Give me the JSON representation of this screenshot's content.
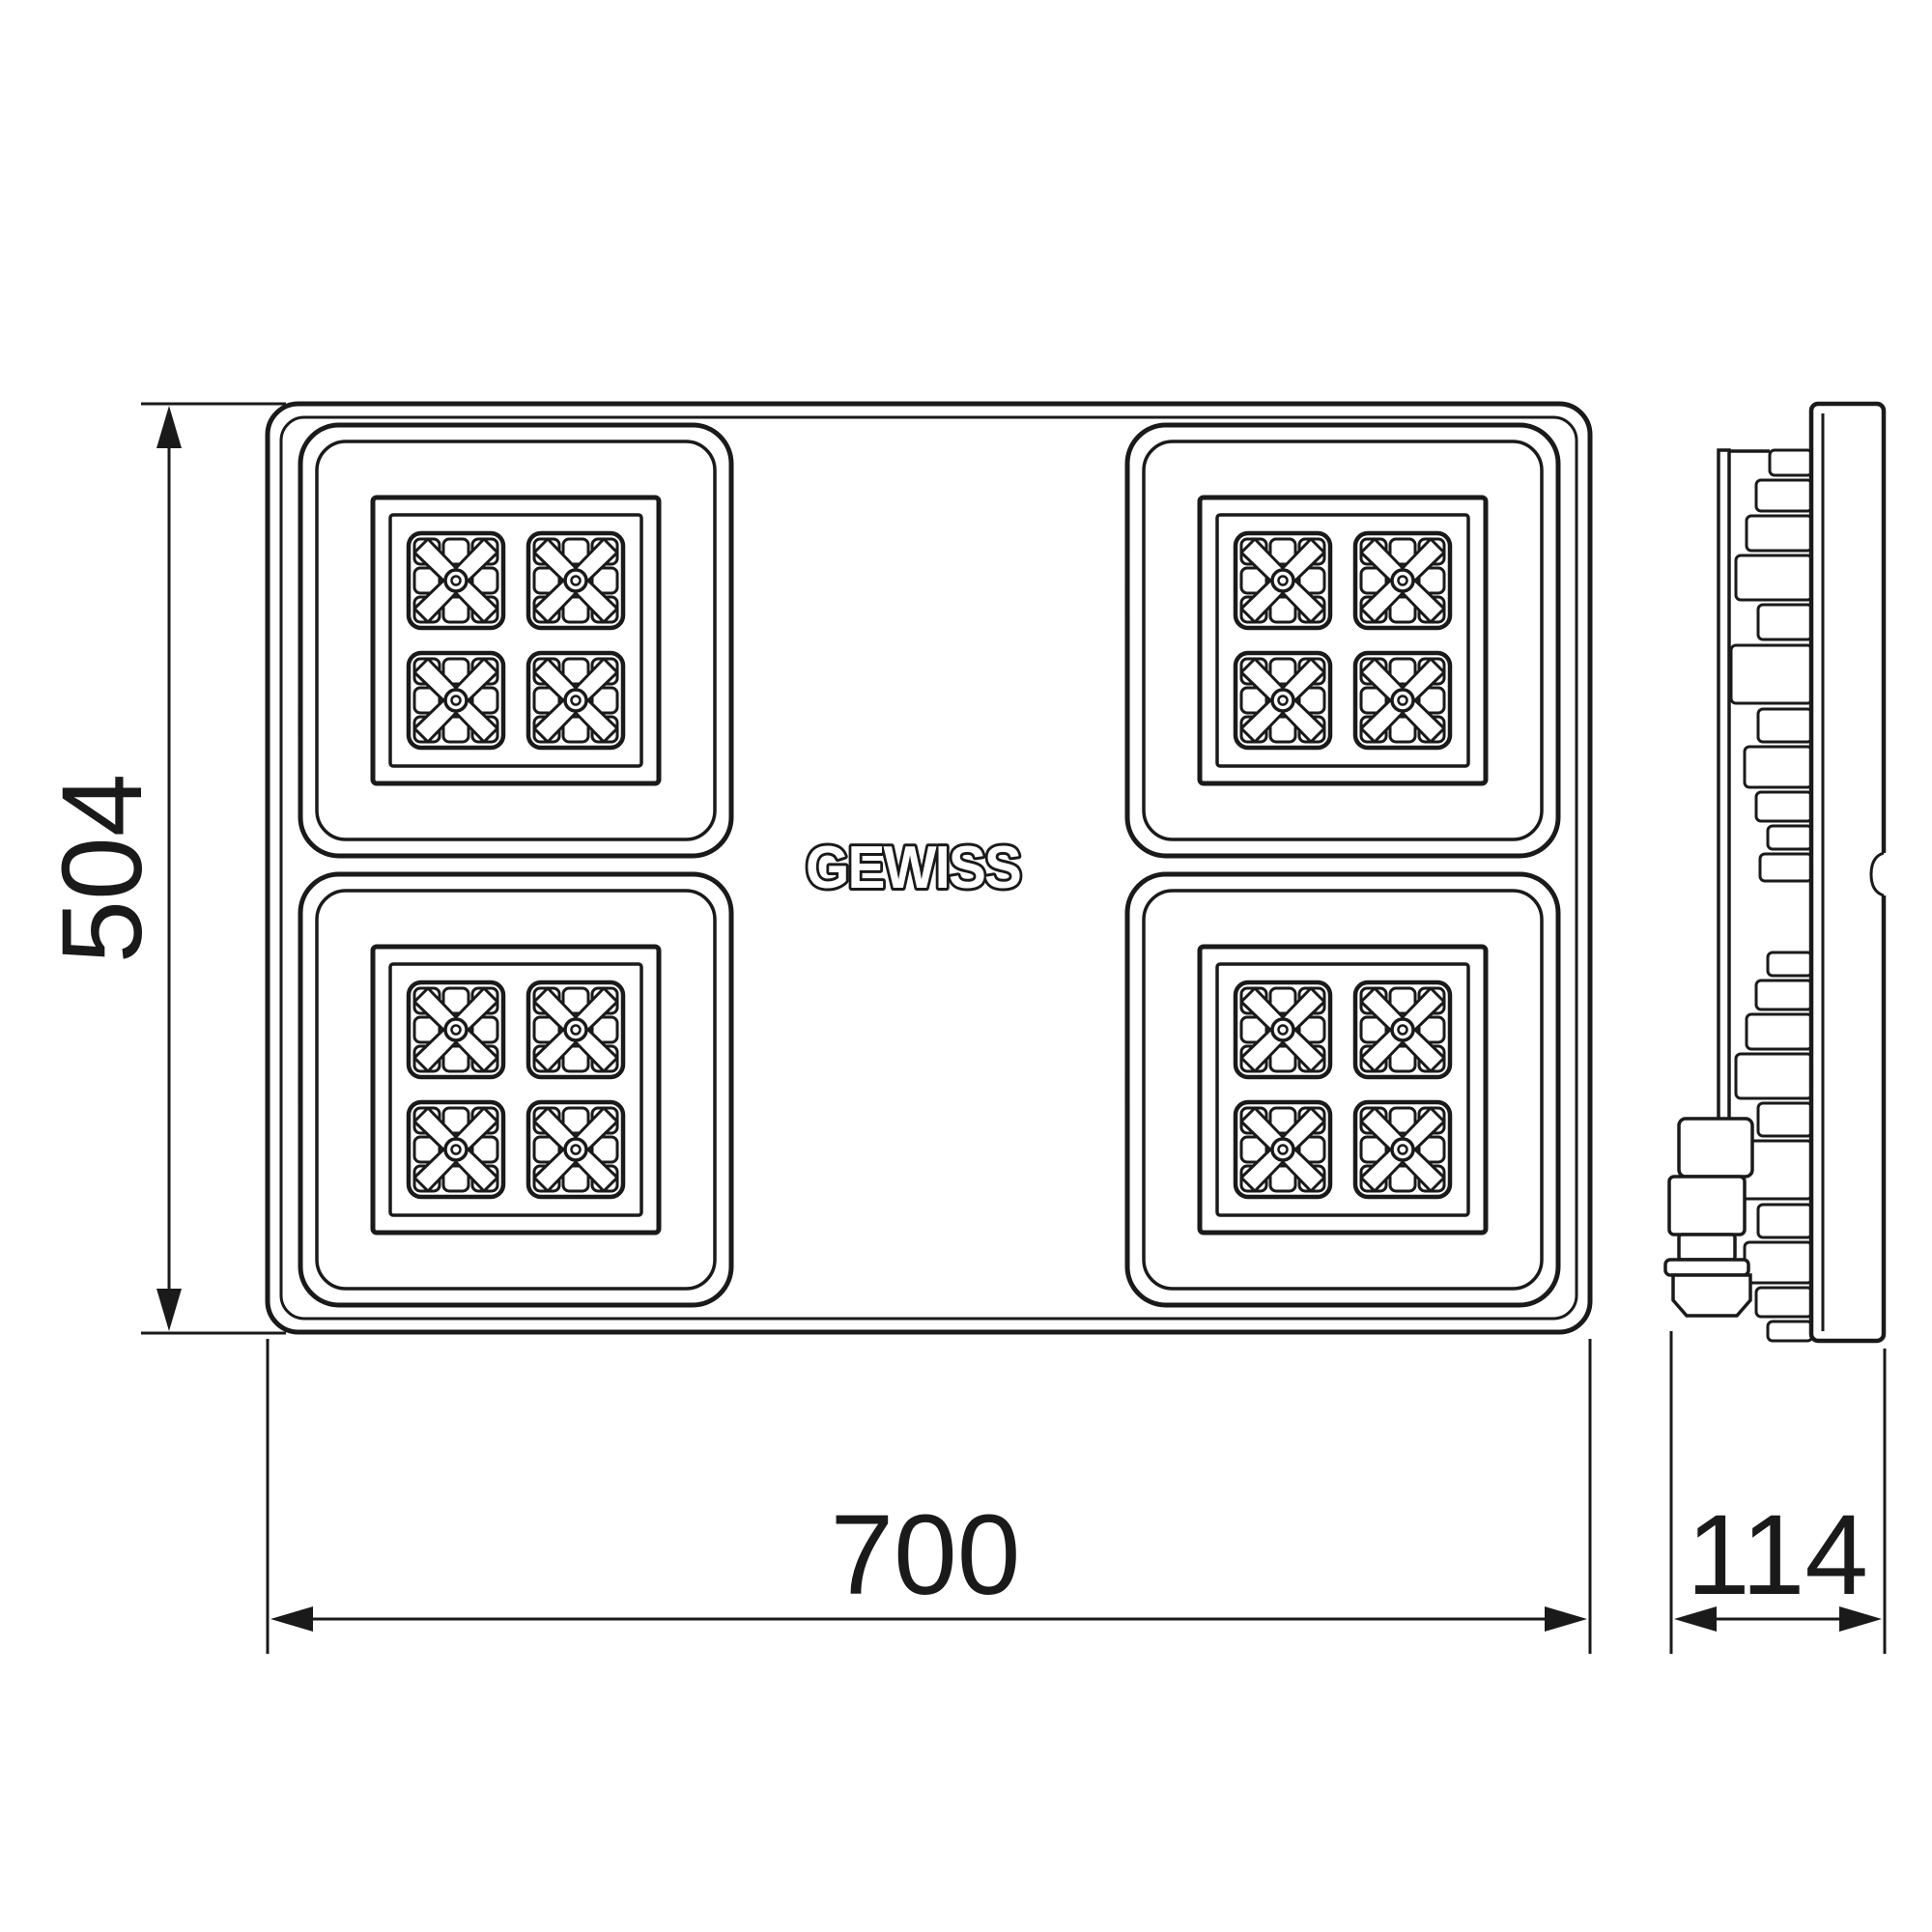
{
  "brand_logo": "GEWISS",
  "dimensions": {
    "height_mm": "504",
    "width_mm": "700",
    "depth_mm": "114"
  },
  "colors": {
    "line": "#1a1a1a",
    "background": "#ffffff"
  }
}
